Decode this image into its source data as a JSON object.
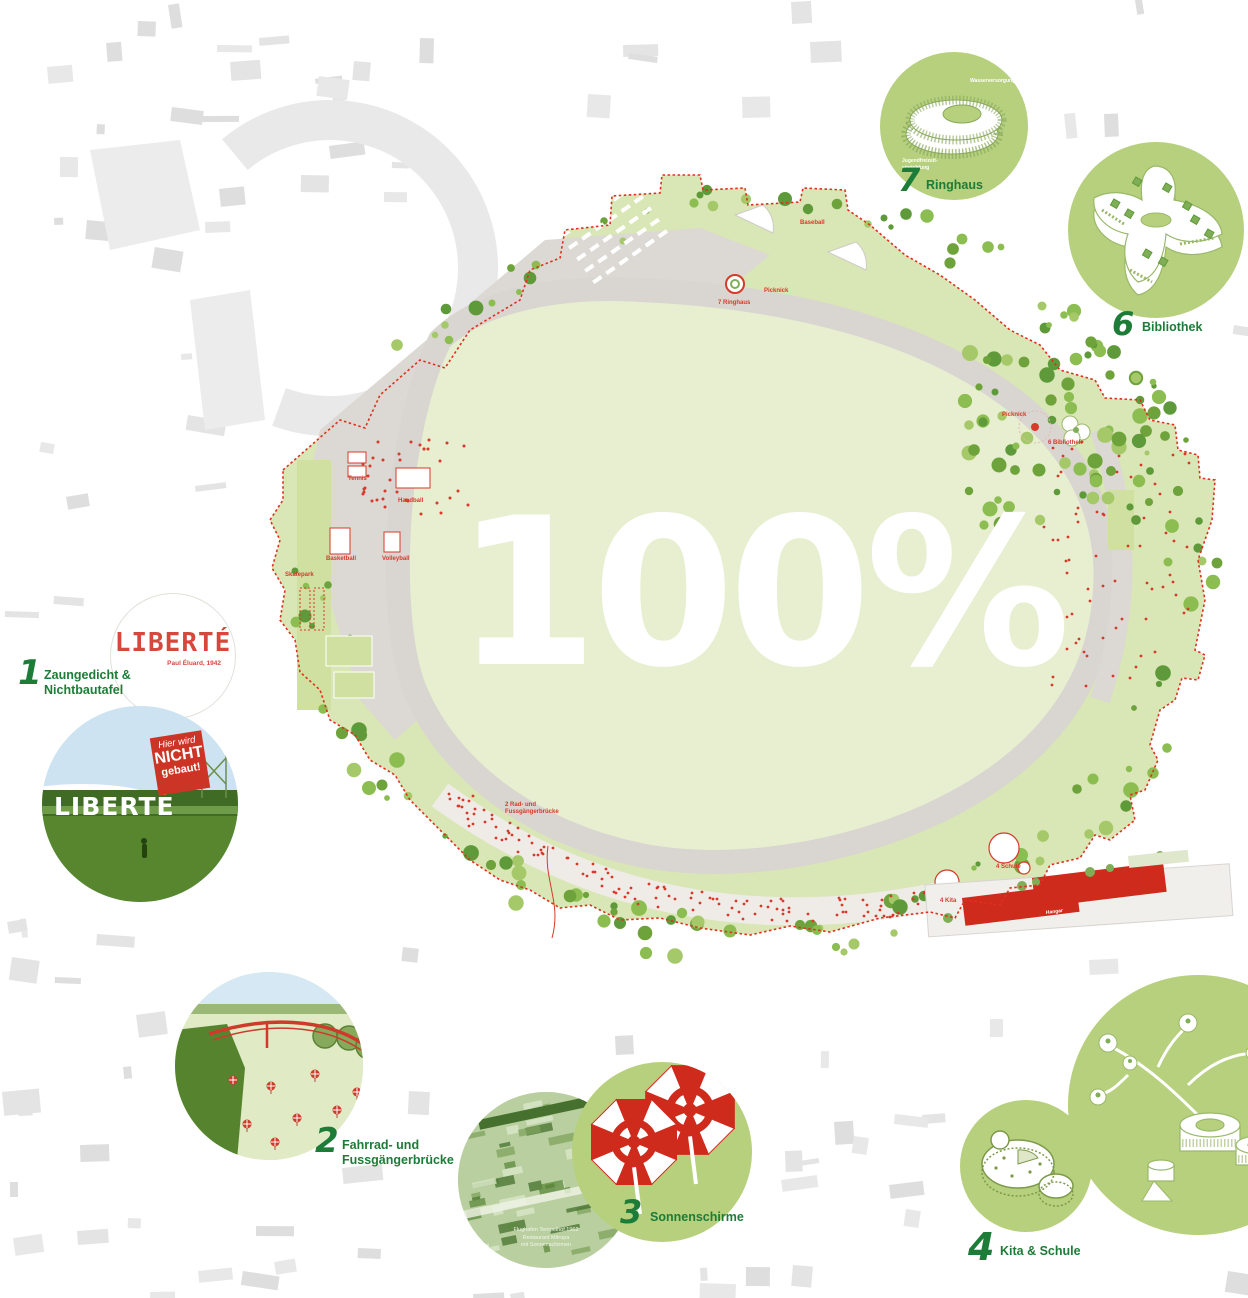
{
  "headline": {
    "text": "100%"
  },
  "colors": {
    "label_green": "#1d7c37",
    "callout_circle_green": "#b6d07d",
    "meadow_green": "#e7efd0",
    "perimeter_green": "#d9e6b5",
    "path_gray": "#dcd8d3",
    "city_block_gray": "#e4e4e4",
    "map_red": "#d63a2a",
    "sign_red": "#cc3526",
    "sky_blue": "#cde3f1",
    "headline_white": "#ffffff"
  },
  "callouts": {
    "c1": {
      "number": "1",
      "label_line1": "Zaungedicht &",
      "label_line2": "Nichtbautafel"
    },
    "c2": {
      "number": "2",
      "label_line1": "Fahrrad- und",
      "label_line2": "Fussgängerbrücke"
    },
    "c3": {
      "number": "3",
      "label": "Sonnenschirme"
    },
    "c4": {
      "number": "4",
      "label": "Kita & Schule"
    },
    "c6": {
      "number": "6",
      "label": "Bibliothek"
    },
    "c7": {
      "number": "7",
      "label": "Ringhaus"
    }
  },
  "liberte_circle": {
    "title": "LIBERTÉ",
    "credit": "Paul Éluard, 1942"
  },
  "photo_circle": {
    "fence_text": "LIBERTÉ",
    "sign_line1": "Hier wird",
    "sign_line2": "NICHT",
    "sign_line3": "gebaut!"
  },
  "aerial_circle": {
    "caption_line1": "Flughafen Tempelhof 1962",
    "caption_line2": "Restaurant Mitropa",
    "caption_line3": "mit Sonnenschirmen"
  },
  "ringhaus_circle": {
    "annotation_top": "Wasserversorgung",
    "annotation_bottom1": "Jugendfreizeit-",
    "annotation_bottom2": "einrichtung"
  },
  "map_labels": {
    "tennis": "Tennis",
    "handball": "Handball",
    "basketball": "Basketball",
    "volleyball": "Volleyball",
    "skatepark": "Skatepark",
    "baseball": "Baseball",
    "picknick_a": "Picknick",
    "picknick_b": "Picknick",
    "bridge_line1": "2 Rad- und",
    "bridge_line2": "Fussgängerbrücke",
    "kita": "4 Kita",
    "schule": "4 Schule",
    "bibliothek": "6 Bibliothek",
    "ringhaus": "7 Ringhaus",
    "hangar": "Hangar"
  }
}
